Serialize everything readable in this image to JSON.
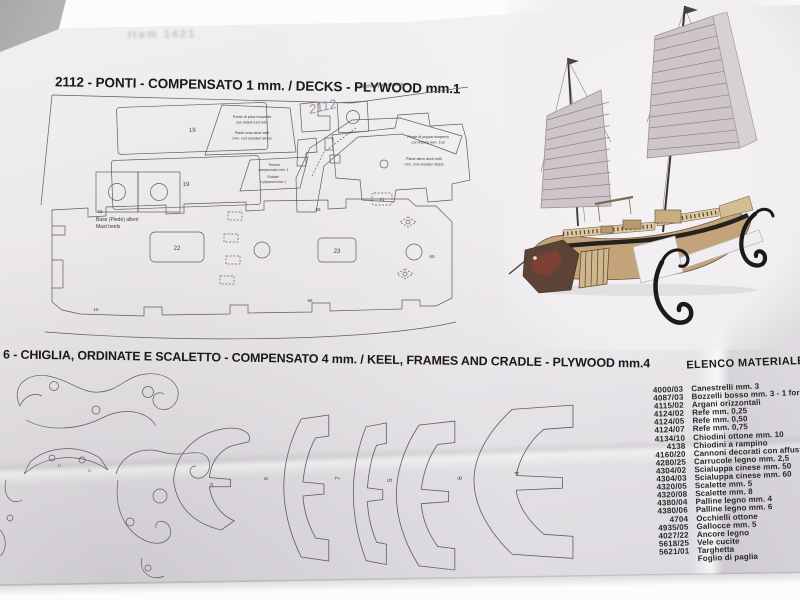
{
  "sheet": {
    "show_through": "Item 1421",
    "decks": {
      "heading": "2112 - PONTI - COMPENSATO 1 mm. / DECKS - PLYWOOD mm.1",
      "sheet_code": "2112",
      "part19a": "19",
      "part19b": "19",
      "mast_heels_1": "Base (Piede) alberi",
      "mast_heels_2": "Mast heels",
      "mast_feet": "Base (Piede) alberi    Mast feet",
      "bow_deck": [
        "Ponte di prua ricoperto",
        "con listelli 1x3 mm.",
        "Plank bow deck with",
        "mm. 1x3 wooden strips"
      ],
      "rudder": [
        "Timone",
        "compensato mm. 1.",
        "Rudder",
        "in plywood mm.1"
      ],
      "stern_deck": [
        "Ponte di poppa ricoperto",
        "con listello mm. 1x3",
        "Plank stern deck with",
        "mm. 1x3 wooden strips"
      ],
      "deck22": "22",
      "deck23": "23",
      "deck21": "21",
      "tiny66a": "66",
      "tiny66b": "66",
      "tiny65": "65",
      "tiny15a": "15",
      "tiny15b": "15"
    },
    "keel": {
      "heading": "6 - CHIGLIA, ORDINATE E SCALETTO - COMPENSATO 4 mm. / KEEL, FRAMES AND CRADLE - PLYWOOD mm.4",
      "frames": [
        "7",
        "5",
        "6",
        "4"
      ],
      "bow_frames": [
        "10",
        "8"
      ],
      "cradle_marks": [
        "11",
        "11"
      ]
    },
    "materials": {
      "title": "ELENCO MATERIALE",
      "items": [
        {
          "code": "4000/03",
          "desc": "Canestrelli mm. 3"
        },
        {
          "code": "4087/03",
          "desc": "Bozzelli bosso mm. 3 - 1 foro"
        },
        {
          "code": "4115/02",
          "desc": "Argani orizzontali"
        },
        {
          "code": "4124/02",
          "desc": "Refe mm. 0,25"
        },
        {
          "code": "4124/05",
          "desc": "Refe mm. 0,50"
        },
        {
          "code": "4124/07",
          "desc": "Refe mm. 0,75"
        },
        {
          "code": "4134/10",
          "desc": "Chiodini ottone mm. 10"
        },
        {
          "code": "4138",
          "desc": "Chiodini a rampino"
        },
        {
          "code": "4160/20",
          "desc": "Cannoni decorati con affusto mm."
        },
        {
          "code": "4280/25",
          "desc": "Carrucole legno mm. 2,5"
        },
        {
          "code": "4304/02",
          "desc": "Scialuppa cinese mm. 50"
        },
        {
          "code": "4304/03",
          "desc": "Scialuppa cinese mm. 60"
        },
        {
          "code": "4320/05",
          "desc": "Scalette mm. 5"
        },
        {
          "code": "4320/08",
          "desc": "Scalette mm. 8"
        },
        {
          "code": "4380/04",
          "desc": "Palline legno mm. 4"
        },
        {
          "code": "4380/06",
          "desc": "Palline legno mm. 6"
        },
        {
          "code": "4704",
          "desc": "Occhielli ottone"
        },
        {
          "code": "4935/05",
          "desc": "Gallocce mm. 5"
        },
        {
          "code": "4027/22",
          "desc": "Ancore legno"
        },
        {
          "code": "5618/25",
          "desc": "Vele cucite"
        },
        {
          "code": "5621/01",
          "desc": "Targhetta"
        },
        {
          "code": "",
          "desc": "Foglio di paglia"
        }
      ]
    },
    "colors": {
      "paper": "#eae7ea",
      "ink": "#1a181a",
      "drawing_line": "#605b60",
      "sail": "#cdc5c9",
      "hull_wood": "#c3a47a",
      "stand_black": "#1b191a"
    }
  }
}
